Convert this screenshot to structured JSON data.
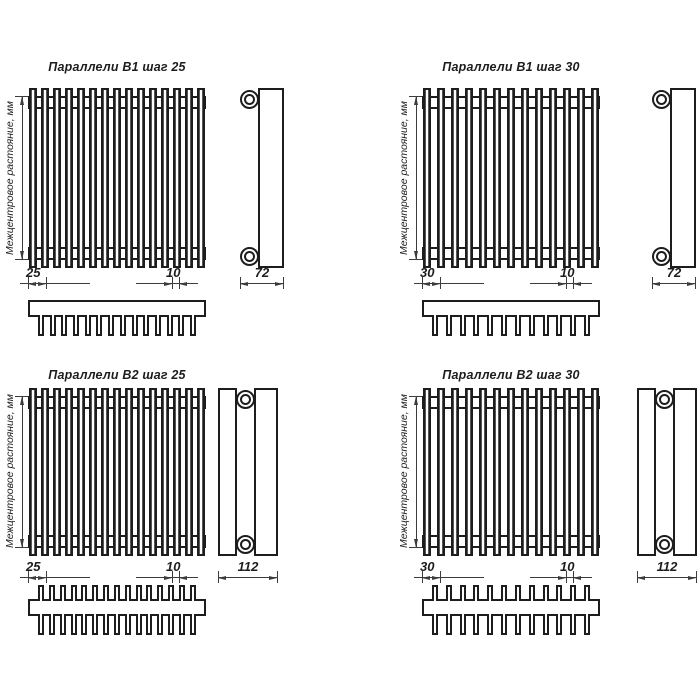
{
  "drawing": {
    "line_color": "#1d1d1d",
    "background_color": "#ffffff",
    "axis_label": "Межцентровое растояние, мм"
  },
  "quadrants": [
    {
      "title": "Параллели В1 шаг 25",
      "axis_label": "Межцентровое растояние, мм",
      "pitch_label": "25",
      "tube_width_label": "10",
      "depth_label": "72",
      "front_tubes": 15,
      "comb_teeth": 14,
      "rows": 1
    },
    {
      "title": "Параллели В1 шаг 30",
      "axis_label": "Межцентровое растояние, мм",
      "pitch_label": "30",
      "tube_width_label": "10",
      "depth_label": "72",
      "front_tubes": 13,
      "comb_teeth": 12,
      "rows": 1
    },
    {
      "title": "Параллели В2 шаг 25",
      "axis_label": "Межцентровое растояние, мм",
      "pitch_label": "25",
      "tube_width_label": "10",
      "depth_label": "112",
      "front_tubes": 15,
      "comb_teeth": 15,
      "rows": 2
    },
    {
      "title": "Параллели В2 шаг 30",
      "axis_label": "Межцентровое растояние, мм",
      "pitch_label": "30",
      "tube_width_label": "10",
      "depth_label": "112",
      "front_tubes": 13,
      "comb_teeth": 12,
      "rows": 2
    }
  ]
}
